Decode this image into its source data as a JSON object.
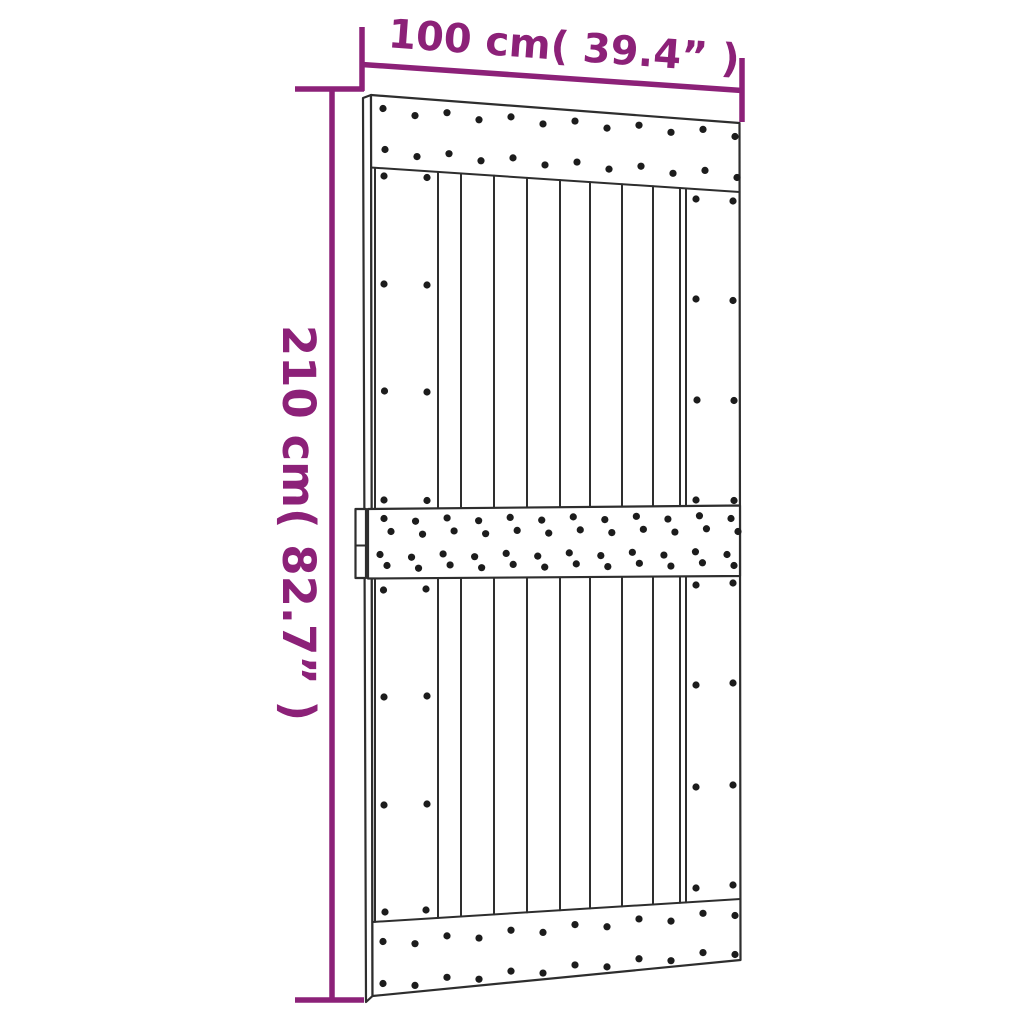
{
  "image_type": "product dimension diagram",
  "subject": "plank door with three cross rails",
  "dimensions": {
    "width": {
      "label": "100 cm( 39.4” )",
      "cm": "100",
      "inches": "39.4"
    },
    "height": {
      "label": "210 cm( 82.7” )",
      "cm": "210",
      "inches": "82.7"
    }
  },
  "colors": {
    "dimension_accent": "#8C2178",
    "door_outline": "#2E2E2E",
    "screw_dot": "#1C1C1C",
    "background": "#FFFFFF"
  }
}
